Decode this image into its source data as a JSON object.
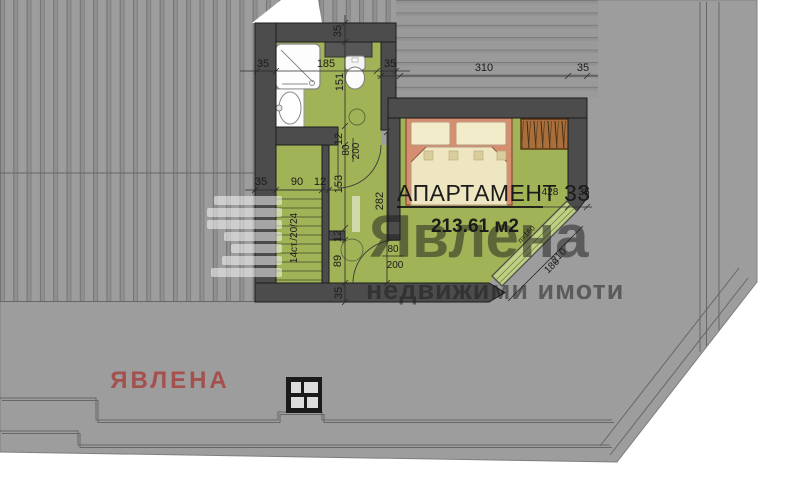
{
  "plan": {
    "apartment_title": "АПАРТАМЕНТ 33",
    "apartment_area": "213.61 м2"
  },
  "watermark": {
    "brand": "Явлена",
    "tagline": "недвижими имоти",
    "corner_brand": "ЯВЛЕНА",
    "color": "#ffffff",
    "corner_color": "#a4504e"
  },
  "labels": {
    "dim_35_bath_left": "35",
    "dim_185": "185",
    "dim_35_bath_right": "35",
    "dim_310": "310",
    "dim_35_bed_right": "35",
    "dim_35_top_v": "35",
    "dim_151": "151",
    "dim_12_a": "12",
    "dim_153": "153",
    "dim_12_b": "12",
    "dim_89": "89",
    "dim_35_bottom_v": "35",
    "dim_282": "282",
    "dim_35_stairs": "35",
    "dim_90": "90",
    "dim_12_stairs": "12",
    "dim_428": "428",
    "dim_35_wall_right": "35",
    "dim_210": "210",
    "dim_180": "180",
    "diag_note": "п=160",
    "door1_w": "80",
    "door1_h": "200",
    "door2_w": "80",
    "door2_h": "200",
    "stairs_note": "14ст./20/24"
  },
  "colors": {
    "roof_gray": "#9d9d9d",
    "wall_dark": "#4c4c4c",
    "floor_green": "#a0b356",
    "bed_frame": "#d58f70",
    "bed_linen": "#efe7c2",
    "wardrobe_wood": "#a86f3d",
    "glass_green": "#bdd083"
  }
}
